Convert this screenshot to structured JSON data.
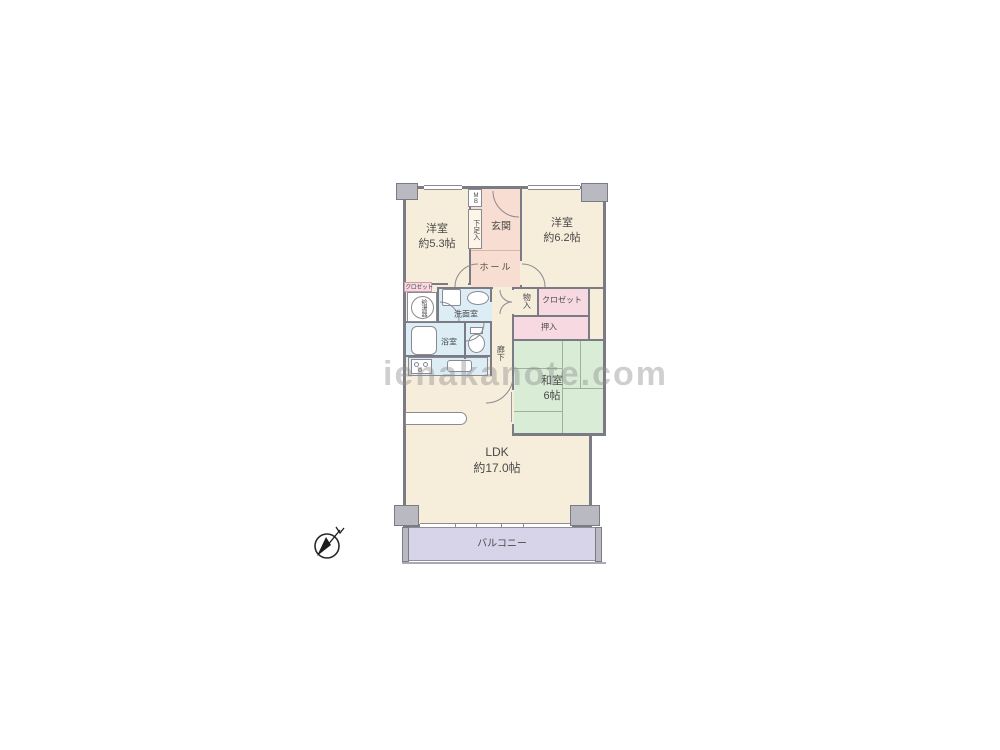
{
  "watermark": "ienakanote.com",
  "rooms": {
    "bedroom1": {
      "name": "洋室",
      "size": "約5.3帖"
    },
    "bedroom2": {
      "name": "洋室",
      "size": "約6.2帖"
    },
    "washitsu": {
      "name": "和室",
      "size": "6帖"
    },
    "ldk": {
      "name": "LDK",
      "size": "約17.0帖"
    },
    "entrance": {
      "label": "玄関"
    },
    "hall": {
      "label": "ホール"
    },
    "corridor": {
      "label": "廊下"
    },
    "washroom": {
      "label": "洗面室"
    },
    "bathroom": {
      "label": "浴室"
    },
    "balcony": {
      "label": "バルコニー"
    }
  },
  "storage": {
    "shoebox": "下足入",
    "meter_box": "MB",
    "water_heater": "給湯器",
    "closet_left": "クロゼット",
    "closet_right": "クロゼット",
    "mono_ire": "物入",
    "oshiire": "押入"
  },
  "colors": {
    "room_cream": "#f6eddb",
    "entrance_pink": "#f8ddd2",
    "closet_pink": "#f7d9e2",
    "wet_area_blue": "#dcedf5",
    "tatami_green": "#d8ecd6",
    "balcony_lavender": "#d7d3e8",
    "wall_gray": "#7b7b86",
    "pillar_gray": "#b9b9c1"
  }
}
